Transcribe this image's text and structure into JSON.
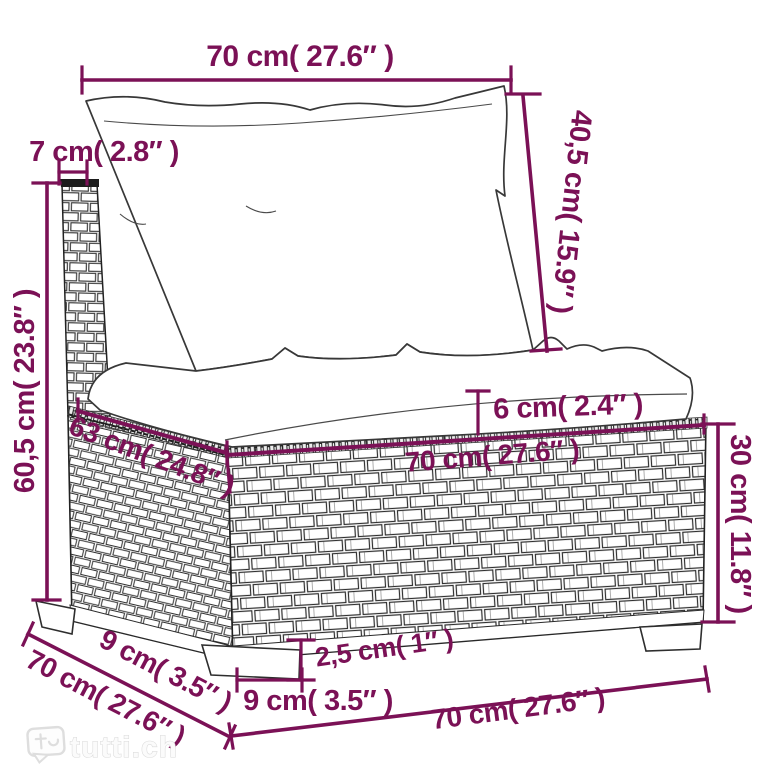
{
  "diagram": {
    "dimension_color": "#7b1156",
    "sketch_color": "#2d2d2d",
    "dimensions": {
      "cushion_width_top": {
        "label": "70 cm( 27.6″ )"
      },
      "back_cushion_height": {
        "label": "40,5 cm( 15.9″ )"
      },
      "back_post_width": {
        "label": "7 cm( 2.8″ )"
      },
      "total_height": {
        "label": "60,5 cm( 23.8″ )"
      },
      "seat_cushion_thickness": {
        "label": "6 cm( 2.4″ )"
      },
      "seat_width": {
        "label": "70 cm( 27.6″ )"
      },
      "seat_depth_diagonal": {
        "label": "63 cm( 24.8″ )"
      },
      "base_height": {
        "label": "30 cm( 11.8″ )"
      },
      "leg_height": {
        "label": "2,5 cm( 1″ )"
      },
      "front_leg_width": {
        "label": "9 cm( 3.5″ )"
      },
      "base_front_width": {
        "label": "70 cm( 27.6″ )"
      },
      "side_leg_width": {
        "label": "9 cm( 3.5″ )"
      },
      "base_depth": {
        "label": "70 cm( 27.6″ )"
      }
    }
  },
  "watermark": {
    "text": "tutti.ch"
  }
}
